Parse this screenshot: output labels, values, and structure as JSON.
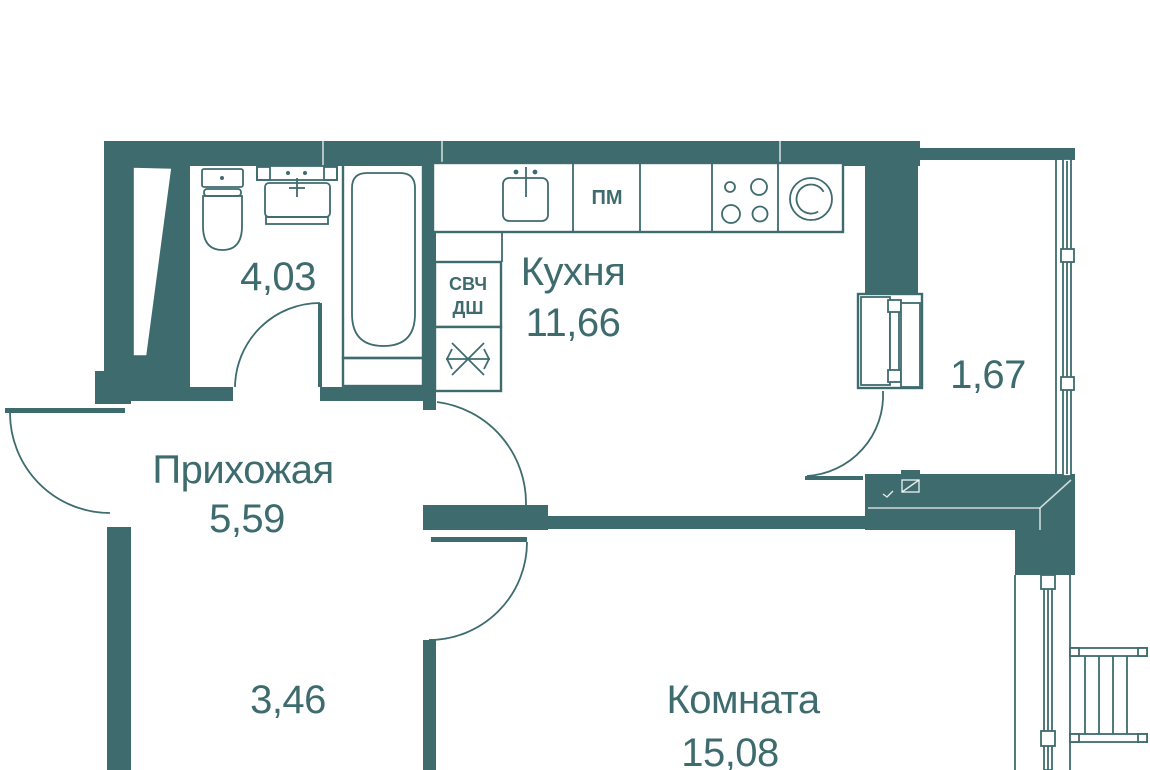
{
  "plan": {
    "rooms": {
      "kitchen": {
        "name": "Кухня",
        "area": "11,66"
      },
      "hallway": {
        "name": "Прихожая",
        "area": "5,59"
      },
      "living_room": {
        "name": "Комната",
        "area": "15,08"
      },
      "bathroom": {
        "area": "4,03"
      },
      "hall_niche": {
        "area": "3,46"
      },
      "balcony": {
        "area": "1,67"
      }
    },
    "appliances": {
      "dishwasher": "ПМ",
      "microwave": "СВЧ",
      "oven": "ДШ"
    },
    "colors": {
      "wall": "#3E6B6E",
      "floor": "#FFFFFF"
    }
  }
}
